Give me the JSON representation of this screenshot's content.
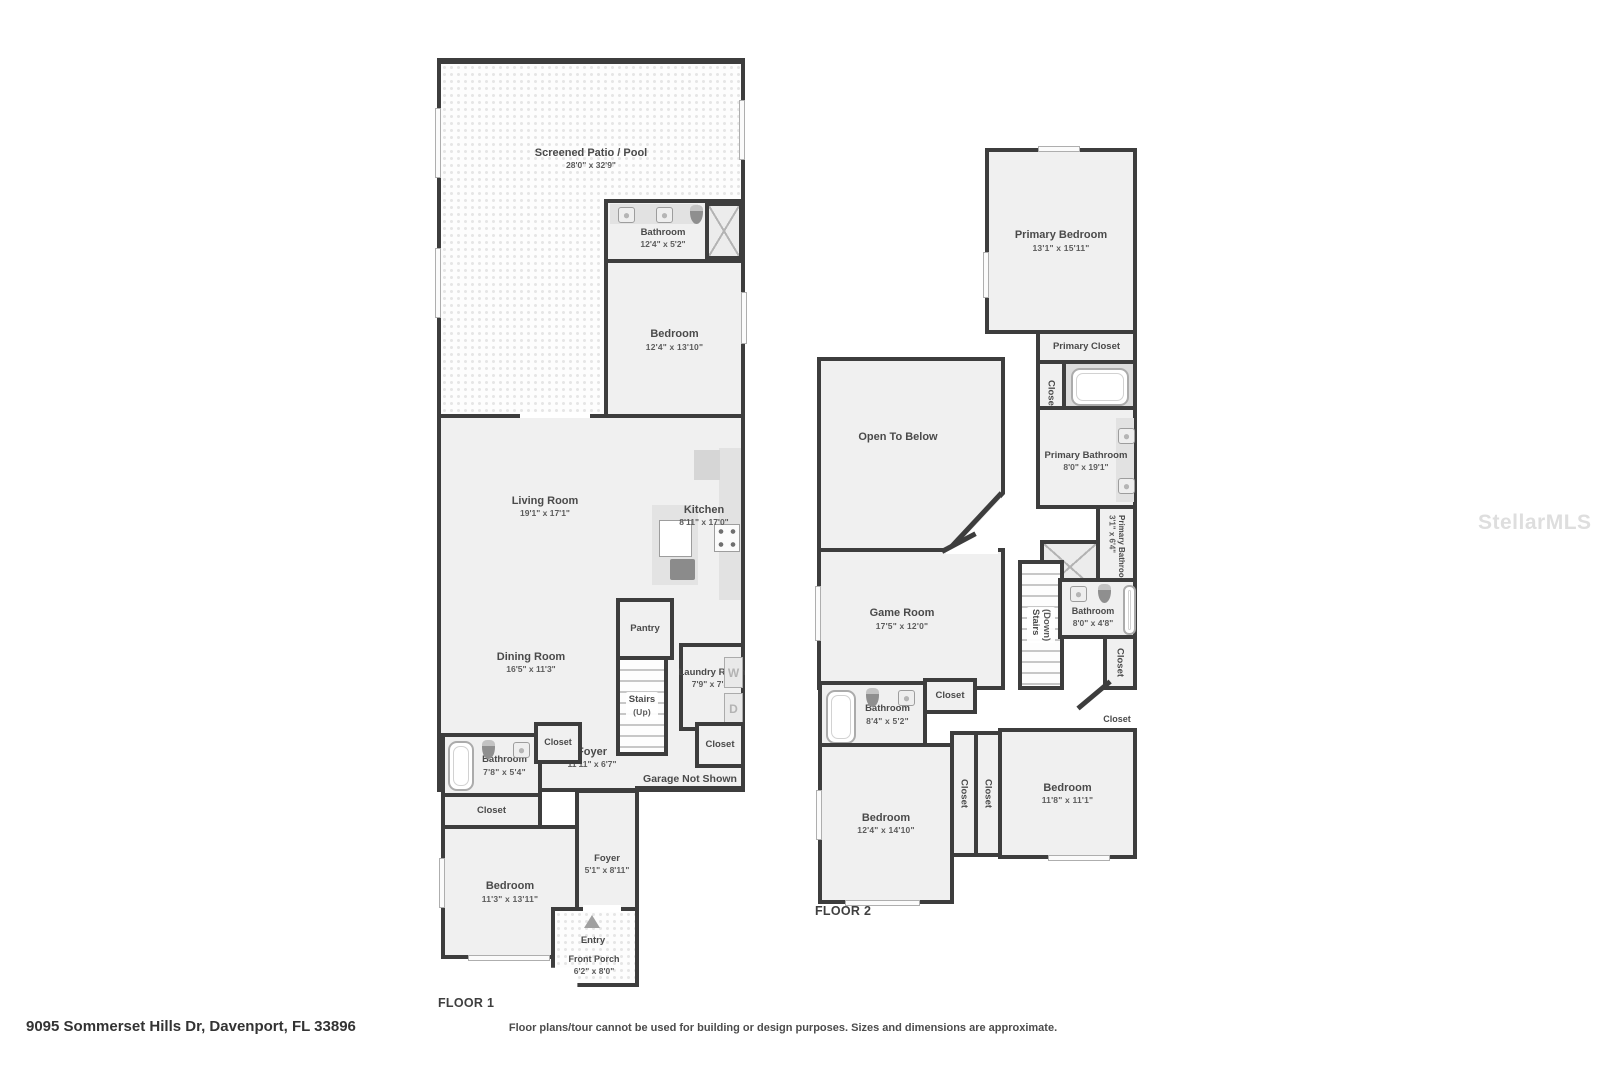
{
  "watermark": "StellarMLS",
  "footer": {
    "address": "9095 Sommerset Hills Dr, Davenport, FL 33896",
    "disclaimer": "Floor plans/tour cannot be used for building or design purposes. Sizes and dimensions are approximate."
  },
  "floor1": {
    "label": "FLOOR 1",
    "garage_note": "Garage Not Shown",
    "appliances": {
      "washer": "W",
      "dryer": "D"
    },
    "rooms": {
      "patio": {
        "name": "Screened Patio / Pool",
        "dims": "28'0\" x 32'9\""
      },
      "bathroom_top": {
        "name": "Bathroom",
        "dims": "12'4\" x 5'2\""
      },
      "bedroom_right": {
        "name": "Bedroom",
        "dims": "12'4\" x 13'10\""
      },
      "closet_hall_wide": {
        "name": "Closet"
      },
      "closet_hall_small": {
        "name": "Closet"
      },
      "living_room": {
        "name": "Living Room",
        "dims": "19'1\" x 17'1\""
      },
      "kitchen": {
        "name": "Kitchen",
        "dims": "8'11\" x 17'0\""
      },
      "pantry": {
        "name": "Pantry"
      },
      "dining_room": {
        "name": "Dining Room",
        "dims": "16'5\" x 11'3\""
      },
      "stairs_up": {
        "name": "Stairs",
        "dims": "(Up)"
      },
      "laundry": {
        "name": "Laundry Room",
        "dims": "7'9\" x 7'5\""
      },
      "bathroom_left": {
        "name": "Bathroom",
        "dims": "7'8\" x 5'4\""
      },
      "closet_bath": {
        "name": "Closet"
      },
      "foyer_main": {
        "name": "Foyer",
        "dims": "11'11\" x 6'7\""
      },
      "closet_garage": {
        "name": "Closet"
      },
      "closet_bed": {
        "name": "Closet"
      },
      "bedroom_front": {
        "name": "Bedroom",
        "dims": "11'3\" x 13'11\""
      },
      "foyer_entry": {
        "name": "Foyer",
        "dims": "5'1\" x 8'11\""
      },
      "entry": {
        "name": "Entry"
      },
      "front_porch": {
        "name": "Front Porch",
        "dims": "6'2\" x 8'0\""
      }
    }
  },
  "floor2": {
    "label": "FLOOR 2",
    "rooms": {
      "primary_bedroom": {
        "name": "Primary Bedroom",
        "dims": "13'1\" x 15'11\""
      },
      "primary_closet": {
        "name": "Primary Closet"
      },
      "closet_tub": {
        "name": "Closet"
      },
      "open_below": {
        "name": "Open To Below"
      },
      "primary_bathroom": {
        "name": "Primary Bathroom",
        "dims": "8'0\" x 19'1\""
      },
      "primary_bathroom_small": {
        "name": "Primary Bathroom",
        "dims": "3'1\" x 6'4\""
      },
      "game_room": {
        "name": "Game Room",
        "dims": "17'5\" x 12'0\""
      },
      "stairs_down": {
        "name": "Stairs",
        "dims": "(Down)"
      },
      "bathroom_mid": {
        "name": "Bathroom",
        "dims": "8'0\" x 4'8\""
      },
      "closet_mid": {
        "name": "Closet"
      },
      "closet_hall": {
        "name": "Closet"
      },
      "bathroom_low": {
        "name": "Bathroom",
        "dims": "8'4\" x 5'2\""
      },
      "closet_bath": {
        "name": "Closet"
      },
      "bedroom_left": {
        "name": "Bedroom",
        "dims": "12'4\" x 14'10\""
      },
      "closet_a": {
        "name": "Closet"
      },
      "closet_b": {
        "name": "Closet"
      },
      "bedroom_right": {
        "name": "Bedroom",
        "dims": "11'8\" x 11'1\""
      }
    }
  }
}
